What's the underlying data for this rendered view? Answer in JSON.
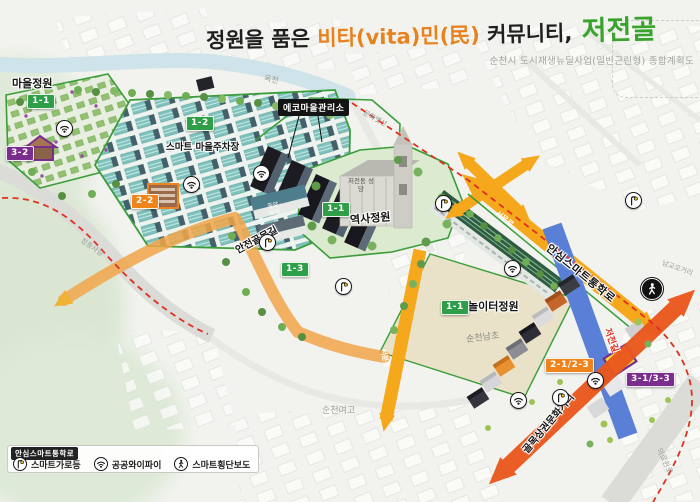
{
  "title": {
    "prefix": "정원을 품은 ",
    "highlight": "비타(vita)민(民)",
    "middle": " 커뮤니티,",
    "brand": " 저전골",
    "subtitle": "순천시 도시재생뉴딜사업(일반근린형) 종합계획도"
  },
  "labels": {
    "stream": "옥천",
    "village_garden": "마을정원",
    "smart_parking": "스마트 마을주차장",
    "eco_center": "에코마을관리소",
    "culture_line": "문화옛선",
    "cathedral": "저전동 성당",
    "kindergarten": "중앙유치원",
    "history_garden": "역사정원",
    "safe_alley": "안전골목길",
    "playground_garden": "놀이터정원",
    "elementary_school": "순천남초",
    "girls_high_school": "순천여고",
    "school_route": "안심스마트통학로",
    "seomun_road": "서문로",
    "jeojeon_road": "저전길",
    "namgyo_intersection": "남교오거리",
    "jeongchungsa_road": "정충사길",
    "medical_center_road": "의료원로",
    "culture_street": "골목상권문화거리"
  },
  "badges": {
    "village_garden": "1-1",
    "smart_parking": "1-2",
    "safe_alley": "1-3",
    "history_garden": "1-1",
    "playground_garden": "1-1",
    "anchor_building": "2-2",
    "house_purple": "3-2",
    "commercial": "2-1/2-3",
    "shops": "3-1/3-3"
  },
  "legend": {
    "title": "안심스마트통학로",
    "items": [
      {
        "icon": "streetlight-icon",
        "label": "스마트가로등"
      },
      {
        "icon": "wifi-icon",
        "label": "공공와이파이"
      },
      {
        "icon": "crosswalk-icon",
        "label": "스마트횡단보도"
      }
    ]
  },
  "colors": {
    "title_orange": "#e8821e",
    "title_green": "#3aa32d",
    "badge_green": "#2f9e48",
    "badge_orange": "#f0841c",
    "badge_purple": "#7b2d8e",
    "route_yellow": "#f5a81c",
    "road_blue": "#5a7fd6",
    "arrow_orange_red": "#ea571d",
    "boundary_red": "#e0301e",
    "area_outline_green": "#3a9d3a"
  }
}
